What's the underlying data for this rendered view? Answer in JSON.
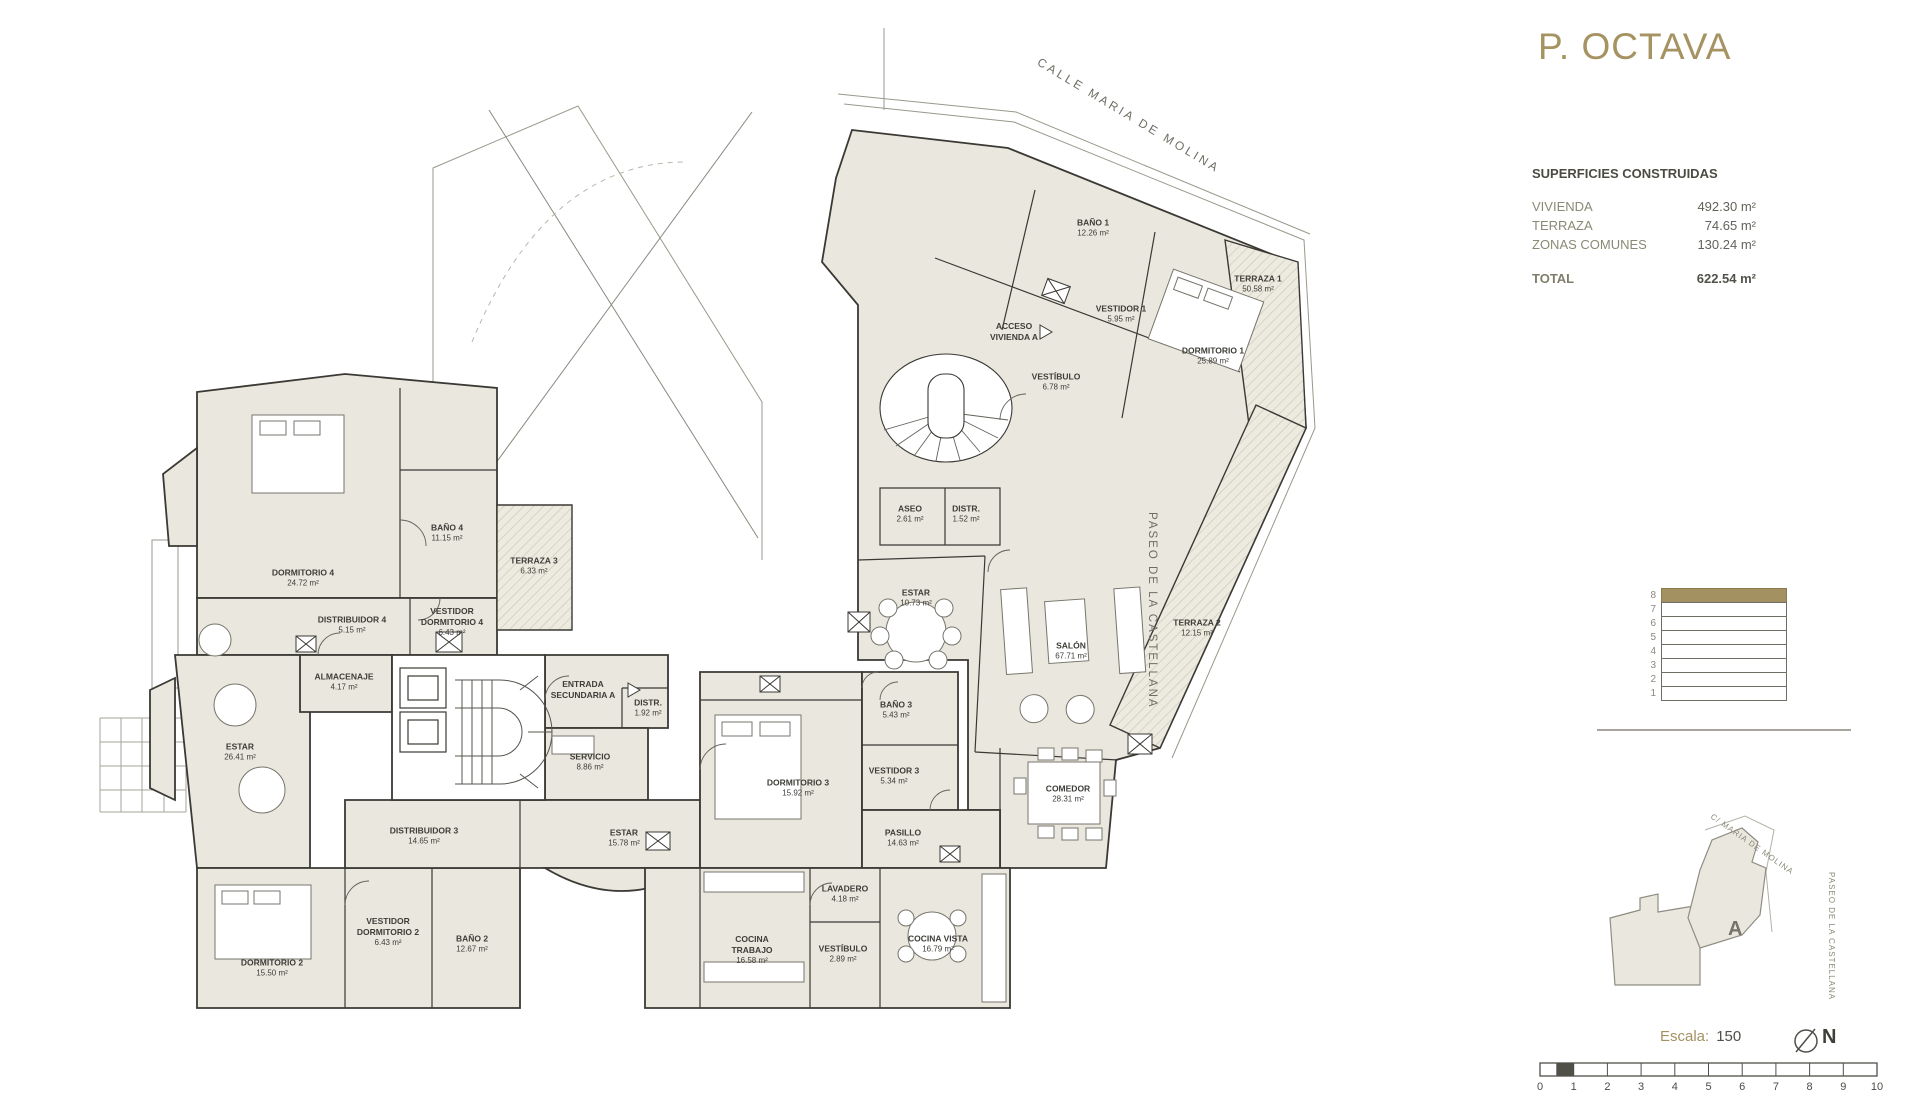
{
  "title": "P. OCTAVA",
  "streets": {
    "calle": "CALLE MARIA DE MOLINA",
    "paseo": "PASEO DE LA CASTELLANA"
  },
  "surfaces": {
    "heading": "SUPERFICIES CONSTRUIDAS",
    "rows": [
      {
        "label": "VIVIENDA",
        "value": "492.30 m²"
      },
      {
        "label": "TERRAZA",
        "value": "74.65 m²"
      },
      {
        "label": "ZONAS COMUNES",
        "value": "130.24 m²"
      }
    ],
    "total": {
      "label": "TOTAL",
      "value": "622.54 m²"
    }
  },
  "floors": {
    "levels": [
      "8",
      "7",
      "6",
      "5",
      "4",
      "3",
      "2",
      "1"
    ],
    "active": "8"
  },
  "key_plan": {
    "unit": "A",
    "street_top": "C/ MARIA DE MOLINA",
    "street_right": "PASEO DE LA CASTELLANA"
  },
  "scale_info": {
    "label": "Escala:",
    "value": "150",
    "north": "N",
    "numbers": [
      "0",
      "1",
      "2",
      "3",
      "4",
      "5",
      "6",
      "7",
      "8",
      "9",
      "10"
    ]
  },
  "colors": {
    "accent": "#a39161",
    "room_fill": "#e9e7de",
    "wall": "#3a3934",
    "muted_text": "#8b8974"
  },
  "plan": {
    "rooms": [
      {
        "name": "BAÑO 1",
        "area": "12.26 m²"
      },
      {
        "name": "TERRAZA 1",
        "area": "50.58 m²"
      },
      {
        "name": "VESTIDOR 1",
        "area": "5.95 m²"
      },
      {
        "name": "DORMITORIO 1",
        "area": "25.89 m²"
      },
      {
        "name": "ACCESO VIVIENDA A",
        "area": ""
      },
      {
        "name": "VESTÍBULO",
        "area": "6.78 m²"
      },
      {
        "name": "ASEO",
        "area": "2.61 m²"
      },
      {
        "name": "DISTR.",
        "area": "1.52 m²"
      },
      {
        "name": "ESTAR",
        "area": "10.73 m²"
      },
      {
        "name": "SALÓN",
        "area": "67.71 m²"
      },
      {
        "name": "TERRAZA 2",
        "area": "12.15 m²"
      },
      {
        "name": "COMEDOR",
        "area": "28.31 m²"
      },
      {
        "name": "BAÑO 3",
        "area": "5.43 m²"
      },
      {
        "name": "VESTIDOR 3",
        "area": "5.34 m²"
      },
      {
        "name": "PASILLO",
        "area": "14.63 m²"
      },
      {
        "name": "DORMITORIO 3",
        "area": "15.92 m²"
      },
      {
        "name": "SERVICIO",
        "area": "8.86 m²"
      },
      {
        "name": "ENTRADA SECUNDARIA A",
        "area": ""
      },
      {
        "name": "DISTR.",
        "area": "1.92 m²"
      },
      {
        "name": "ALMACENAJE",
        "area": "4.17 m²"
      },
      {
        "name": "DORMITORIO 4",
        "area": "24.72 m²"
      },
      {
        "name": "BAÑO 4",
        "area": "11.15 m²"
      },
      {
        "name": "DISTRIBUIDOR 4",
        "area": "5.15 m²"
      },
      {
        "name": "VESTIDOR DORMITORIO 4",
        "area": "6.43 m²"
      },
      {
        "name": "TERRAZA 3",
        "area": "6.33 m²"
      },
      {
        "name": "ESTAR",
        "area": "26.41 m²"
      },
      {
        "name": "DISTRIBUIDOR 3",
        "area": "14.65 m²"
      },
      {
        "name": "ESTAR",
        "area": "15.78 m²"
      },
      {
        "name": "DORMITORIO 2",
        "area": "15.50 m²"
      },
      {
        "name": "VESTIDOR DORMITORIO 2",
        "area": "6.43 m²"
      },
      {
        "name": "BAÑO 2",
        "area": "12.67 m²"
      },
      {
        "name": "COCINA TRABAJO",
        "area": "16.58 m²"
      },
      {
        "name": "VESTÍBULO",
        "area": "2.89 m²"
      },
      {
        "name": "COCINA VISTA",
        "area": "16.79 m²"
      },
      {
        "name": "LAVADERO",
        "area": "4.18 m²"
      }
    ]
  }
}
